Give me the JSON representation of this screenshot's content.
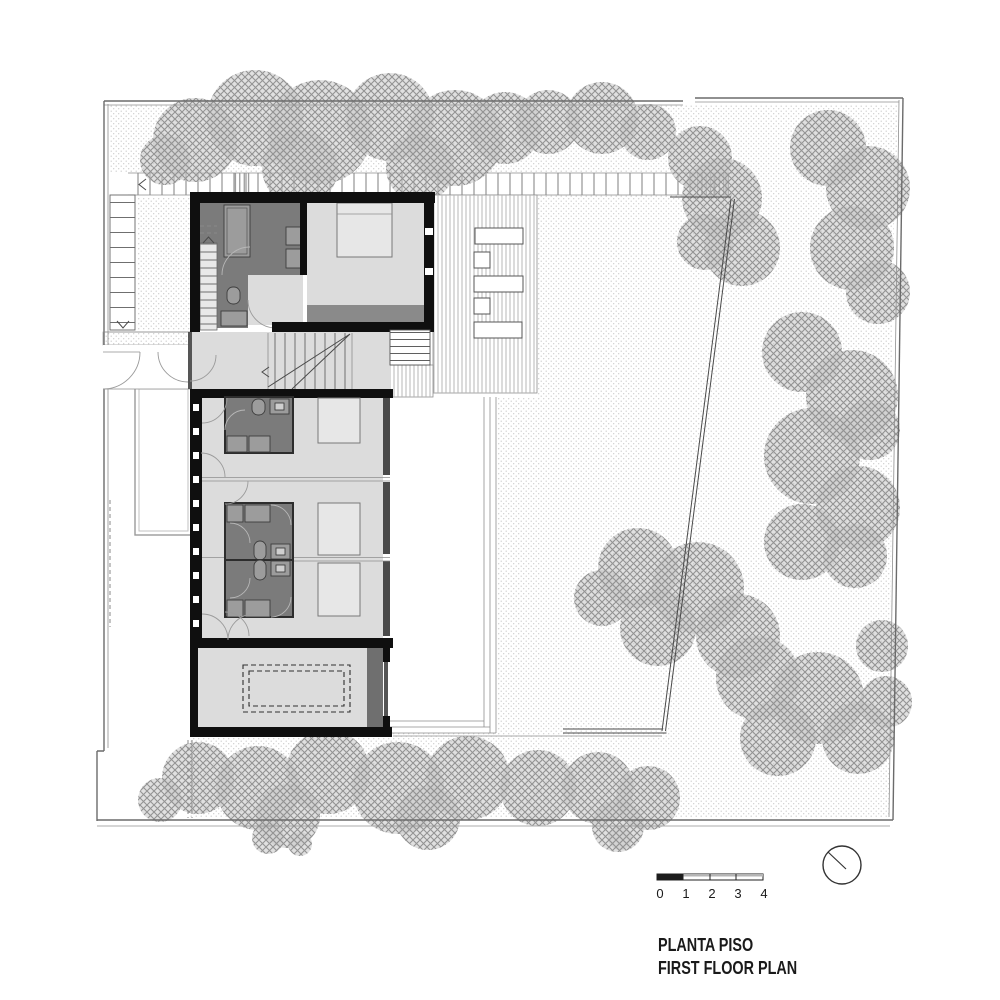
{
  "title": {
    "primary": "PLANTA PISO",
    "secondary": "FIRST FLOOR PLAN"
  },
  "scale_bar": {
    "labels": [
      "0",
      "1",
      "2",
      "3",
      "4"
    ]
  },
  "north_indicator": {
    "icon": "compass-circle-with-needle"
  },
  "colors": {
    "paper": "#ffffff",
    "text": "#1a1a1a",
    "line": "#4a4a4a",
    "boundary": "#6b6b6b",
    "wall": "#0f0f0f",
    "room-dark": "#7b7b7b",
    "room-mid": "#9c9c9c",
    "room-light": "#dcdcdc",
    "bed": "#e7e7e7",
    "balcony": "#8a8a8a",
    "tree-line": "#939393",
    "tree-fill": "#c6c6c6",
    "stipple-dot": "#cdcdcd",
    "hatch-line": "#b7b7b7"
  }
}
